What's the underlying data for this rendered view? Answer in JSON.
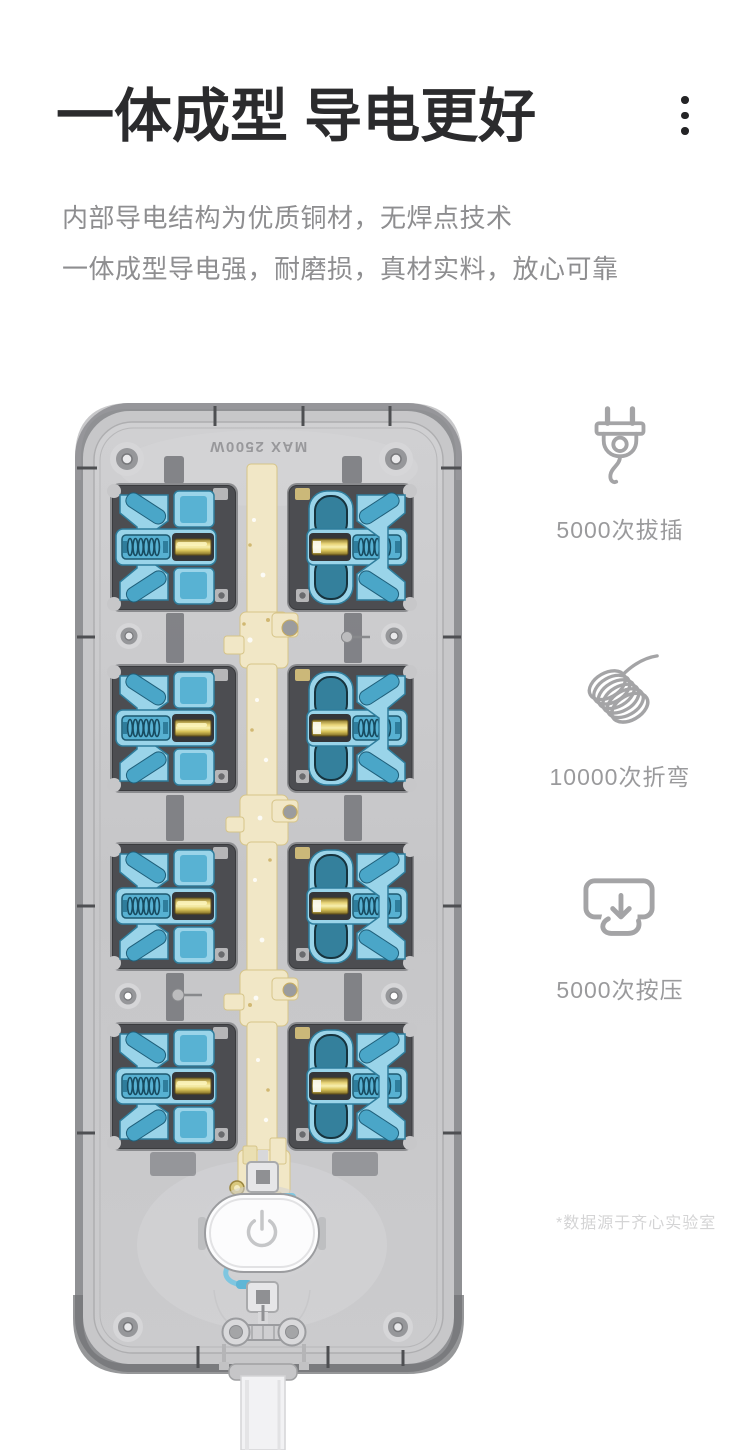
{
  "header": {
    "title": "一体成型 导电更好",
    "subtitle_line1": "内部导电结构为优质铜材，无焊点技术",
    "subtitle_line2": "一体成型导电强，耐磨损，真材实料，放心可靠"
  },
  "menu": {
    "icon": "kebab-vertical-dots"
  },
  "product": {
    "marking": "MAX 2500W",
    "socket_count": 8
  },
  "features": [
    {
      "icon": "plug-icon",
      "label": "5000次拔插"
    },
    {
      "icon": "coil-wire-icon",
      "label": "10000次折弯"
    },
    {
      "icon": "press-icon",
      "label": "5000次按压"
    }
  ],
  "footnote": "*数据源于齐心实验室",
  "colors": {
    "title": "#2b2b2d",
    "subtitle": "#8e8e90",
    "feature_label": "#9a9a9c",
    "footnote": "#d4d4d5",
    "icon_stroke": "#a4a4a6",
    "body_shell": "#c7c7c9",
    "module_dark": "#4c4d51",
    "insulator_blue": "#9ed8ec",
    "insulator_blue_dark": "#2e7d9c",
    "copper_busbar": "#f1e7c6",
    "brass_contact": "#caae52"
  }
}
